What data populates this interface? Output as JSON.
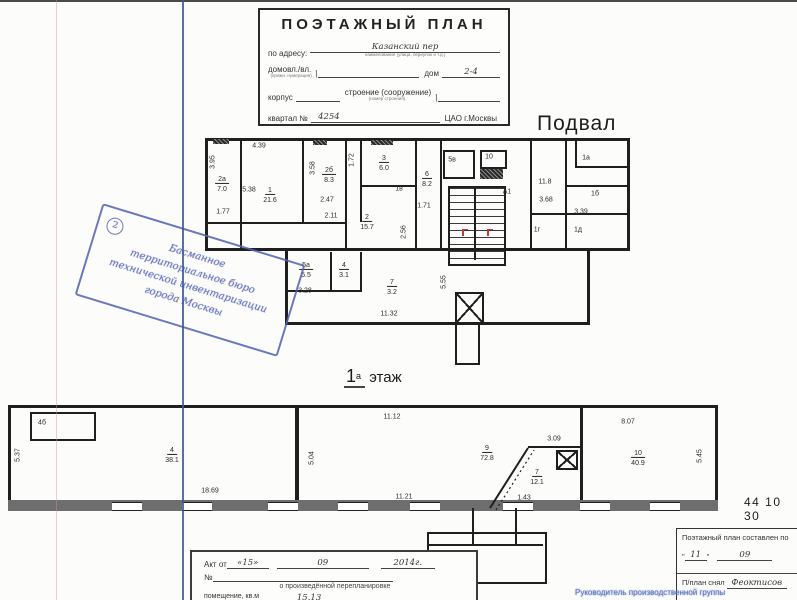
{
  "title_block": {
    "title": "ПОЭТАЖНЫЙ ПЛАН",
    "address_label": "по адресу:",
    "address_value": "Казанский пер",
    "address_caption": "наименование (улица, переулок и т.д.)",
    "domvl_label": "домовл./вл.",
    "domvl_caption": "(прежн. нумерация)",
    "dom_label": "дом",
    "dom_value": "2-4",
    "korpus_label": "корпус",
    "stroenie_label": "строение (сооружение)",
    "stroenie_caption": "(номер строения)",
    "kvartal_label": "квартал №",
    "kvartal_value": "4254",
    "district": "ЦАО г.Москвы"
  },
  "stamp": {
    "number": "2",
    "lines": [
      "Басманное",
      "территориальное бюро",
      "технической инвентаризации",
      "города Москвы"
    ]
  },
  "basement": {
    "title": "Подвал",
    "rooms": [
      {
        "num": "2а",
        "area": "7.0",
        "x": 222,
        "y": 181
      },
      {
        "num": "1",
        "area": "21.6",
        "x": 270,
        "y": 192
      },
      {
        "num": "2б",
        "area": "8.3",
        "x": 329,
        "y": 172
      },
      {
        "num": "3",
        "area": "6.0",
        "x": 384,
        "y": 160
      },
      {
        "num": "2",
        "area": "15.7",
        "x": 367,
        "y": 219
      },
      {
        "num": "6",
        "area": "8.2",
        "x": 427,
        "y": 176
      },
      {
        "num": "5а",
        "area": "5.5",
        "x": 306,
        "y": 267
      },
      {
        "num": "4",
        "area": "3.1",
        "x": 344,
        "y": 267
      },
      {
        "num": "7",
        "area": "3.2",
        "x": 392,
        "y": 284
      }
    ],
    "labels": [
      {
        "t": "3.95",
        "x": 213,
        "y": 162,
        "v": 1
      },
      {
        "t": "4.39",
        "x": 259,
        "y": 146
      },
      {
        "t": "5.38",
        "x": 249,
        "y": 190
      },
      {
        "t": "1.77",
        "x": 223,
        "y": 212
      },
      {
        "t": "3.58",
        "x": 313,
        "y": 168,
        "v": 1
      },
      {
        "t": "2.47",
        "x": 327,
        "y": 200
      },
      {
        "t": "2.11",
        "x": 331,
        "y": 216
      },
      {
        "t": "1.72",
        "x": 352,
        "y": 160,
        "v": 1
      },
      {
        "t": "1.71",
        "x": 424,
        "y": 206
      },
      {
        "t": "2.56",
        "x": 404,
        "y": 232,
        "v": 1
      },
      {
        "t": "5в",
        "x": 452,
        "y": 160
      },
      {
        "t": "10",
        "x": 489,
        "y": 157
      },
      {
        "t": "А1",
        "x": 507,
        "y": 192
      },
      {
        "t": "11.8",
        "x": 545,
        "y": 182
      },
      {
        "t": "1а",
        "x": 586,
        "y": 158
      },
      {
        "t": "1б",
        "x": 595,
        "y": 194
      },
      {
        "t": "3.68",
        "x": 546,
        "y": 200
      },
      {
        "t": "3.39",
        "x": 581,
        "y": 212
      },
      {
        "t": "1г",
        "x": 537,
        "y": 230
      },
      {
        "t": "1д",
        "x": 578,
        "y": 230
      },
      {
        "t": "1в",
        "x": 399,
        "y": 189
      },
      {
        "t": "3.28",
        "x": 305,
        "y": 291
      },
      {
        "t": "5.55",
        "x": 444,
        "y": 282,
        "v": 1
      },
      {
        "t": "11.32",
        "x": 389,
        "y": 314
      }
    ]
  },
  "floor1": {
    "title_num": "1",
    "title_sup": "а",
    "title_word": "этаж",
    "rooms": [
      {
        "num": "4",
        "area": "38.1",
        "x": 172,
        "y": 452
      },
      {
        "num": "9",
        "area": "72.8",
        "x": 487,
        "y": 450
      },
      {
        "num": "7",
        "area": "12.1",
        "x": 537,
        "y": 474
      },
      {
        "num": "10",
        "area": "40.9",
        "x": 638,
        "y": 455
      }
    ],
    "labels": [
      {
        "t": "5.37",
        "x": 18,
        "y": 455,
        "v": 1
      },
      {
        "t": "18.69",
        "x": 210,
        "y": 491
      },
      {
        "t": "11.12",
        "x": 392,
        "y": 417
      },
      {
        "t": "5.04",
        "x": 312,
        "y": 458,
        "v": 1
      },
      {
        "t": "11.21",
        "x": 404,
        "y": 497
      },
      {
        "t": "3.09",
        "x": 554,
        "y": 439
      },
      {
        "t": "1.43",
        "x": 524,
        "y": 498
      },
      {
        "t": "8.07",
        "x": 628,
        "y": 422
      },
      {
        "t": "5.45",
        "x": 700,
        "y": 456,
        "v": 1
      },
      {
        "t": "4б",
        "x": 42,
        "y": 423
      }
    ]
  },
  "ref_number": "44 10 30",
  "act_box": {
    "line1_label": "Акт от",
    "line1_day": "«15»",
    "line1_month": "09",
    "line1_year": "2014г.",
    "line2_label": "№",
    "line3": "о произведённой перепланировке",
    "line4_label": "помещение, кв.м",
    "line4_value": "15.13"
  },
  "footer_table": {
    "row1": "Поэтажный план составлен по",
    "quote_open": "\"",
    "day": "11",
    "quote_close": "\"",
    "month": "09",
    "row3_label": "П/план снял",
    "row3_value": "Феоктисов",
    "row4_blue": "Руководитель производственной группы"
  }
}
